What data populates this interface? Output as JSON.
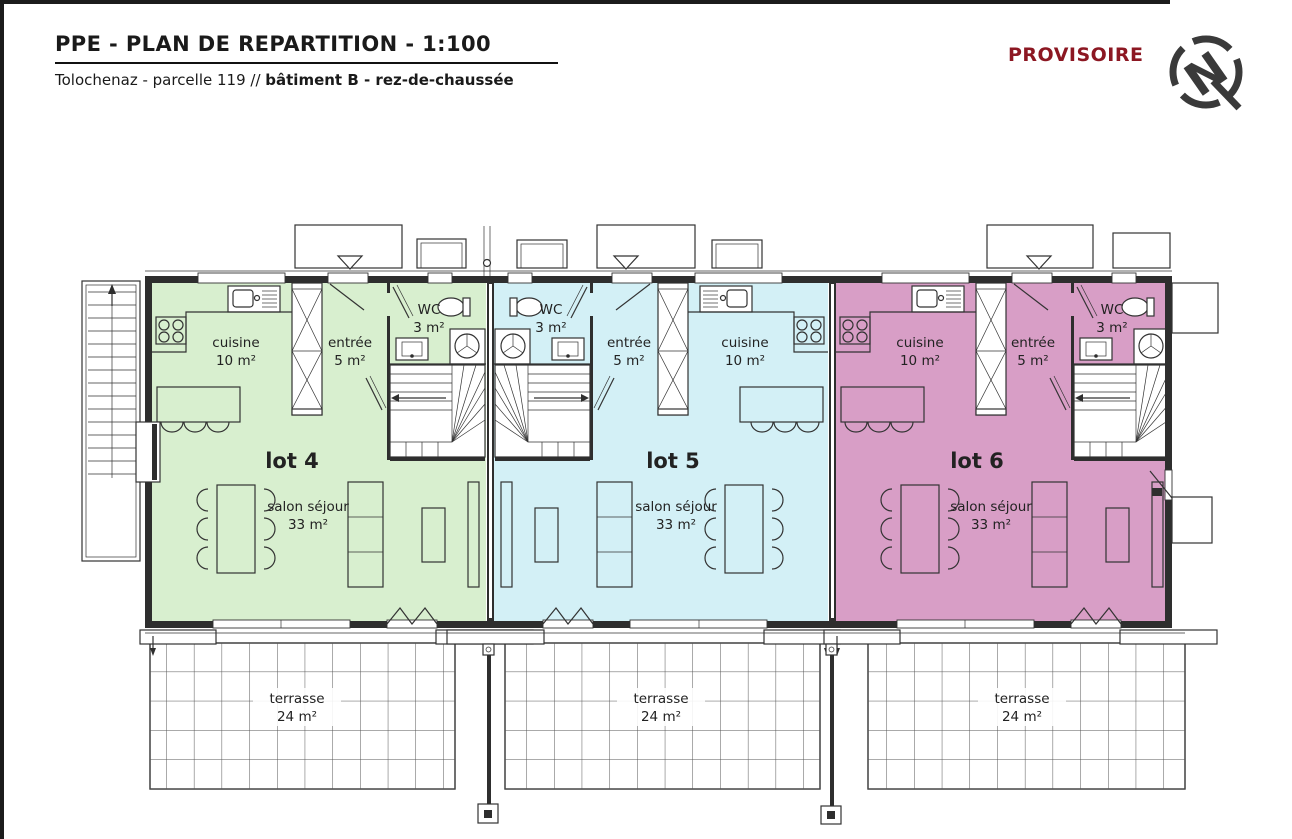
{
  "page": {
    "status": "PROVISOIRE",
    "north_label": "N"
  },
  "header": {
    "title": "PPE - PLAN DE REPARTITION - 1:100",
    "subtitle_prefix": "Tolochenaz - parcelle 119 // ",
    "subtitle_bold": "bâtiment B - rez-de-chaussée"
  },
  "colors": {
    "lot4_fill": "#d8efcf",
    "lot5_fill": "#d3f0f6",
    "lot6_fill": "#d89ec6",
    "status_red": "#8c1722",
    "line": "#333333"
  },
  "lots": [
    {
      "label": "lot 4",
      "color": "#d8efcf",
      "cuisine_name": "cuisine",
      "cuisine_area": "10 m²",
      "entree_name": "entrée",
      "entree_area": "5 m²",
      "wc_name": "WC",
      "wc_area": "3 m²",
      "salon_name": "salon séjour",
      "salon_area": "33 m²",
      "terrasse_name": "terrasse",
      "terrasse_area": "24 m²"
    },
    {
      "label": "lot 5",
      "color": "#d3f0f6",
      "cuisine_name": "cuisine",
      "cuisine_area": "10 m²",
      "entree_name": "entrée",
      "entree_area": "5 m²",
      "wc_name": "WC",
      "wc_area": "3 m²",
      "salon_name": "salon séjour",
      "salon_area": "33 m²",
      "terrasse_name": "terrasse",
      "terrasse_area": "24 m²"
    },
    {
      "label": "lot 6",
      "color": "#d89ec6",
      "cuisine_name": "cuisine",
      "cuisine_area": "10 m²",
      "entree_name": "entrée",
      "entree_area": "5 m²",
      "wc_name": "WC",
      "wc_area": "3 m²",
      "salon_name": "salon séjour",
      "salon_area": "33 m²",
      "terrasse_name": "terrasse",
      "terrasse_area": "24 m²"
    }
  ]
}
